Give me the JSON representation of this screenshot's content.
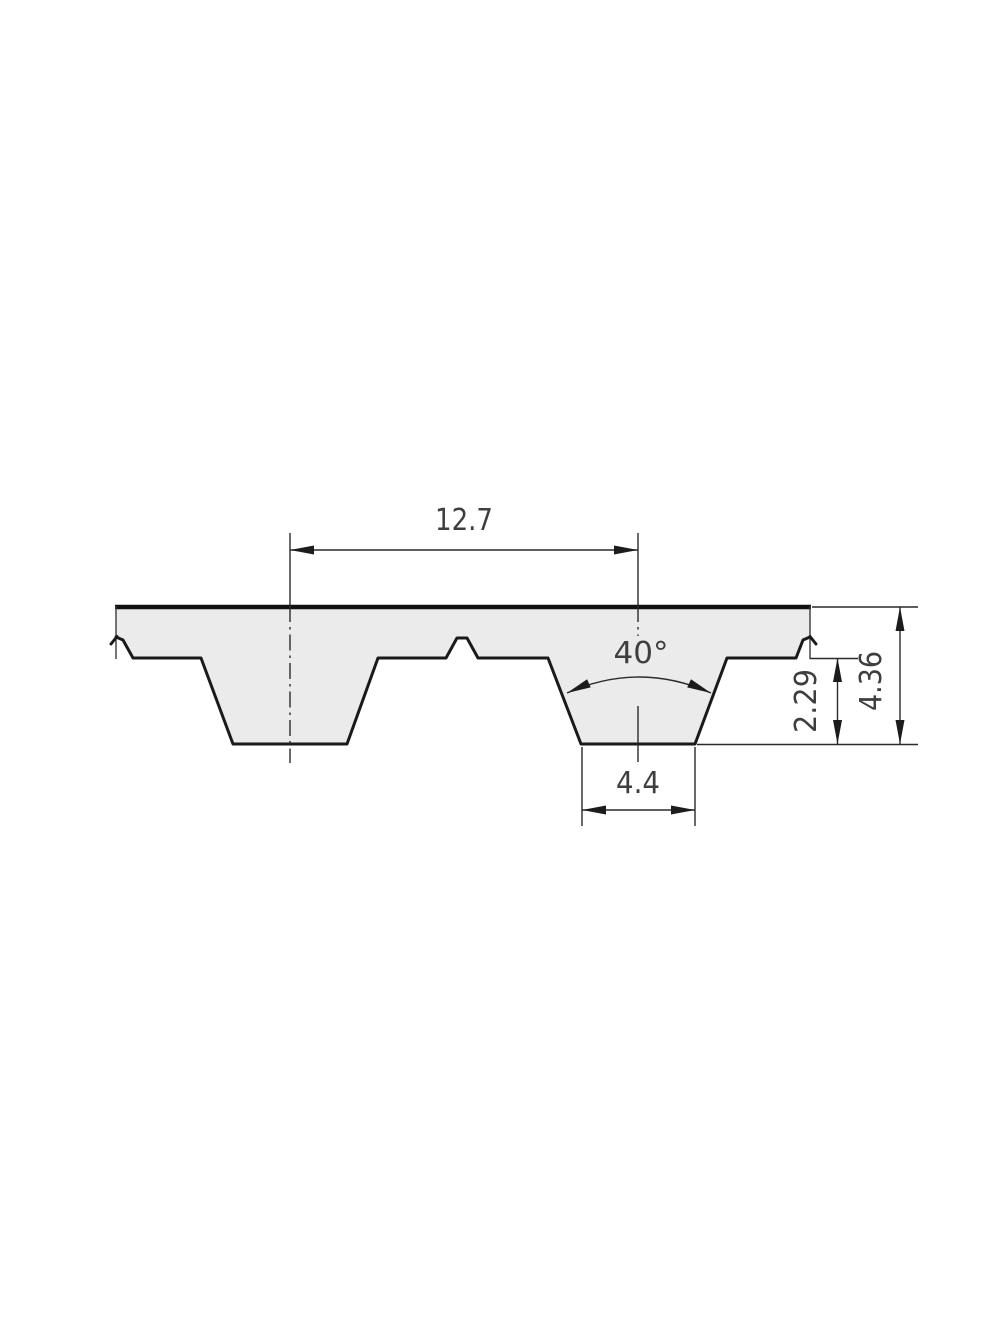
{
  "drawing": {
    "type": "technical-drawing",
    "subject": "timing-belt-tooth-profile-cross-section",
    "labels": {
      "pitch": "12.7",
      "angle": "40°",
      "tooth_width": "4.4",
      "tooth_depth": "2.29",
      "thickness": "4.36"
    },
    "colors": {
      "background": "#ffffff",
      "belt_fill": "#ebebeb",
      "outline": "#1a1a1a",
      "dimension_text": "#3e3e3e"
    }
  }
}
